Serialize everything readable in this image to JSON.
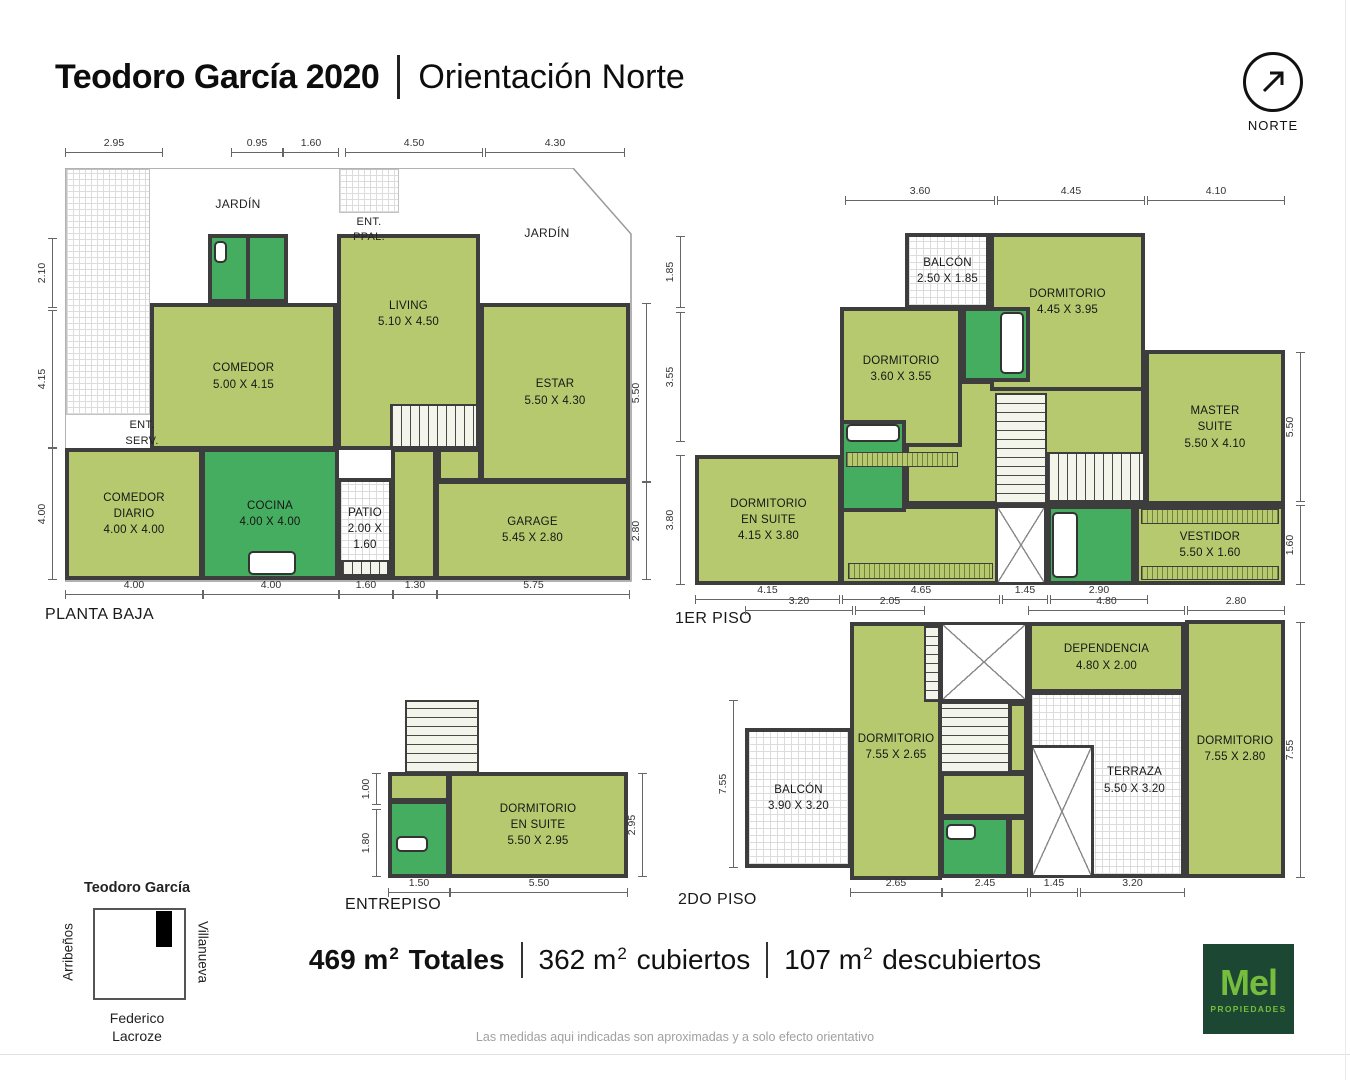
{
  "title": {
    "bold": "Teodoro García 2020",
    "separator": "|",
    "regular": "Orientación Norte"
  },
  "north": {
    "label": "NORTE"
  },
  "colors": {
    "room_light": "#b6c96e",
    "room_dark": "#45ad5f",
    "wall": "#3d3d3d",
    "logo_bg": "#1b4733",
    "logo_green": "#76bd3d"
  },
  "plans": [
    {
      "id": "planta-baja",
      "title": {
        "t": "PLANTA BAJA",
        "x": 45,
        "y": 606
      },
      "elements": [
        {
          "n": "jardin-hatch-left",
          "f": "lothatch",
          "x": 66,
          "y": 169,
          "w": 84,
          "h": 246
        },
        {
          "n": "ent-ppal-hatch",
          "f": "lothatch",
          "x": 339,
          "y": 169,
          "w": 60,
          "h": 44
        },
        {
          "n": "room-wet-a",
          "f": "dark",
          "x": 208,
          "y": 234,
          "w": 42,
          "h": 69
        },
        {
          "n": "room-wet-b",
          "f": "dark",
          "x": 246,
          "y": 234,
          "w": 42,
          "h": 69
        },
        {
          "n": "room-comedor",
          "f": "light",
          "x": 150,
          "y": 303,
          "w": 187,
          "h": 147,
          "lines": [
            "COMEDOR",
            "5.00 X 4.15"
          ]
        },
        {
          "n": "room-living",
          "f": "light",
          "x": 337,
          "y": 234,
          "w": 143,
          "h": 216,
          "lines": [
            "LIVING",
            "5.10 X 4.50"
          ],
          "ldy": -28
        },
        {
          "n": "room-estar",
          "f": "light",
          "x": 480,
          "y": 303,
          "w": 150,
          "h": 179,
          "lines": [
            "ESTAR",
            "5.50 X 4.30"
          ]
        },
        {
          "n": "room-comedor-diario",
          "f": "light",
          "x": 65,
          "y": 448,
          "w": 138,
          "h": 132,
          "lines": [
            "COMEDOR",
            "DIARIO",
            "4.00 X 4.00"
          ]
        },
        {
          "n": "room-cocina",
          "f": "dark",
          "x": 201,
          "y": 448,
          "w": 138,
          "h": 132,
          "lines": [
            "COCINA",
            "4.00 X 4.00"
          ]
        },
        {
          "n": "stairs-pb",
          "f": "stair-v",
          "x": 390,
          "y": 404,
          "w": 88,
          "h": 44
        },
        {
          "n": "hall-pb",
          "f": "light",
          "x": 391,
          "y": 448,
          "w": 46,
          "h": 132
        },
        {
          "n": "mid-strip-pb",
          "f": "light",
          "x": 437,
          "y": 448,
          "w": 45,
          "h": 34
        },
        {
          "n": "room-patio",
          "f": "hatch",
          "x": 337,
          "y": 478,
          "w": 56,
          "h": 102,
          "lines": [
            "PATIO",
            "2.00 X 1.60"
          ]
        },
        {
          "n": "room-garage",
          "f": "light",
          "x": 435,
          "y": 480,
          "w": 195,
          "h": 100,
          "lines": [
            "GARAGE",
            "5.45 X 2.80"
          ]
        },
        {
          "n": "patio-step-hatch",
          "f": "stair-v",
          "x": 341,
          "y": 560,
          "w": 48,
          "h": 16
        },
        {
          "n": "fixture-stove",
          "f": "fixture",
          "x": 248,
          "y": 551,
          "w": 48,
          "h": 24
        },
        {
          "n": "fixture-wet",
          "f": "fixture",
          "x": 214,
          "y": 241,
          "w": 13,
          "h": 22
        }
      ],
      "dims": [
        {
          "t": "2.95",
          "o": "h",
          "x": 65,
          "y": 152,
          "len": 98
        },
        {
          "t": "0.95",
          "o": "h",
          "x": 231,
          "y": 152,
          "len": 52
        },
        {
          "t": "1.60",
          "o": "h",
          "x": 283,
          "y": 152,
          "len": 56
        },
        {
          "t": "4.50",
          "o": "h",
          "x": 345,
          "y": 152,
          "len": 138
        },
        {
          "t": "4.30",
          "o": "h",
          "x": 485,
          "y": 152,
          "len": 140
        },
        {
          "t": "2.10",
          "o": "v",
          "x": 52,
          "y": 238,
          "len": 70
        },
        {
          "t": "4.15",
          "o": "v",
          "x": 52,
          "y": 310,
          "len": 138
        },
        {
          "t": "4.00",
          "o": "v",
          "x": 52,
          "y": 448,
          "len": 132
        },
        {
          "t": "5.50",
          "o": "v",
          "x": 646,
          "y": 303,
          "len": 179
        },
        {
          "t": "2.80",
          "o": "v",
          "x": 646,
          "y": 482,
          "len": 98
        },
        {
          "t": "4.00",
          "o": "h",
          "x": 65,
          "y": 594,
          "len": 138
        },
        {
          "t": "4.00",
          "o": "h",
          "x": 203,
          "y": 594,
          "len": 136
        },
        {
          "t": "1.60",
          "o": "h",
          "x": 339,
          "y": 594,
          "len": 54
        },
        {
          "t": "1.30",
          "o": "h",
          "x": 393,
          "y": 594,
          "len": 44
        },
        {
          "t": "5.75",
          "o": "h",
          "x": 437,
          "y": 594,
          "len": 193
        }
      ],
      "texts": [
        {
          "n": "jardin-label-left",
          "t": "JARDÍN",
          "x": 238,
          "y": 204,
          "size": 12
        },
        {
          "n": "jardin-label-right",
          "t": "JARDÍN",
          "x": 547,
          "y": 233,
          "size": 12
        },
        {
          "n": "ent-ppal-line1",
          "t": "ENT.",
          "x": 369,
          "y": 222,
          "size": 11
        },
        {
          "n": "ent-ppal-line2",
          "t": "PPAL.",
          "x": 369,
          "y": 237,
          "size": 11
        },
        {
          "n": "ent-serv-line1",
          "t": "ENT.",
          "x": 142,
          "y": 425,
          "size": 11
        },
        {
          "n": "ent-serv-line2",
          "t": "SERV.",
          "x": 142,
          "y": 441,
          "size": 11
        }
      ]
    },
    {
      "id": "1er-piso",
      "title": {
        "t": "1ER PISO",
        "x": 675,
        "y": 610
      },
      "elements": [
        {
          "n": "hall-1p",
          "f": "light",
          "x": 905,
          "y": 380,
          "w": 240,
          "h": 125
        },
        {
          "n": "closet-zone-1p",
          "f": "light",
          "x": 840,
          "y": 505,
          "w": 160,
          "h": 80
        },
        {
          "n": "room-balcon-1p",
          "f": "hatch",
          "x": 905,
          "y": 233,
          "w": 85,
          "h": 76,
          "lines": [
            "BALCÓN",
            "2.50 X 1.85"
          ]
        },
        {
          "n": "room-dormitorio-445",
          "f": "light",
          "x": 990,
          "y": 233,
          "w": 155,
          "h": 158,
          "lines": [
            "DORMITORIO",
            "4.45 X 3.95"
          ],
          "ldy": -10
        },
        {
          "n": "room-dormitorio-360",
          "f": "light",
          "x": 840,
          "y": 307,
          "w": 122,
          "h": 140,
          "lines": [
            "DORMITORIO",
            "3.60 X 3.55"
          ],
          "ldy": -8
        },
        {
          "n": "bath-1p-top",
          "f": "dark",
          "x": 962,
          "y": 307,
          "w": 68,
          "h": 75
        },
        {
          "n": "room-master-suite",
          "f": "light",
          "x": 1145,
          "y": 350,
          "w": 140,
          "h": 155,
          "lines": [
            "MASTER",
            "SUITE",
            "5.50 X 4.10"
          ]
        },
        {
          "n": "room-vestidor",
          "f": "light",
          "x": 1135,
          "y": 505,
          "w": 150,
          "h": 80,
          "lines": [
            "VESTIDOR",
            "5.50 X 1.60"
          ]
        },
        {
          "n": "closet-stripe-top",
          "f": "stripe-v",
          "x": 1141,
          "y": 509,
          "w": 138,
          "h": 15
        },
        {
          "n": "closet-stripe-bottom",
          "f": "stripe-v",
          "x": 1141,
          "y": 566,
          "w": 138,
          "h": 14
        },
        {
          "n": "room-dormitorio-en-suite-1p",
          "f": "light",
          "x": 695,
          "y": 455,
          "w": 147,
          "h": 130,
          "lines": [
            "DORMITORIO",
            "EN SUITE",
            "4.15 X 3.80"
          ]
        },
        {
          "n": "bath-1p-mid",
          "f": "dark",
          "x": 840,
          "y": 420,
          "w": 66,
          "h": 92
        },
        {
          "n": "stairs-1p-a",
          "f": "stair-h",
          "x": 995,
          "y": 393,
          "w": 52,
          "h": 112
        },
        {
          "n": "stairs-1p-b",
          "f": "stair-v",
          "x": 1047,
          "y": 452,
          "w": 98,
          "h": 50
        },
        {
          "n": "shaft-1p",
          "f": "shaft",
          "x": 995,
          "y": 505,
          "w": 52,
          "h": 80
        },
        {
          "n": "bath-1p-bottom",
          "f": "dark",
          "x": 1047,
          "y": 505,
          "w": 88,
          "h": 80
        },
        {
          "n": "stripe-1p-left",
          "f": "stripe-v",
          "x": 846,
          "y": 452,
          "w": 112,
          "h": 15
        },
        {
          "n": "stripe-1p-bottomleft",
          "f": "stripe-v",
          "x": 848,
          "y": 563,
          "w": 145,
          "h": 16
        },
        {
          "n": "fixture-tub-mid",
          "f": "fixture",
          "x": 846,
          "y": 424,
          "w": 54,
          "h": 18
        },
        {
          "n": "fixture-tub-top",
          "f": "fixture",
          "x": 1000,
          "y": 312,
          "w": 24,
          "h": 62
        },
        {
          "n": "fixture-tub-bottom",
          "f": "fixture",
          "x": 1052,
          "y": 512,
          "w": 26,
          "h": 66
        }
      ],
      "dims": [
        {
          "t": "3.60",
          "o": "h",
          "x": 845,
          "y": 200,
          "len": 150
        },
        {
          "t": "4.45",
          "o": "h",
          "x": 997,
          "y": 200,
          "len": 148
        },
        {
          "t": "4.10",
          "o": "h",
          "x": 1147,
          "y": 200,
          "len": 138
        },
        {
          "t": "1.85",
          "o": "v",
          "x": 680,
          "y": 236,
          "len": 72
        },
        {
          "t": "3.55",
          "o": "v",
          "x": 680,
          "y": 312,
          "len": 130
        },
        {
          "t": "3.80",
          "o": "v",
          "x": 680,
          "y": 455,
          "len": 130
        },
        {
          "t": "5.50",
          "o": "v",
          "x": 1300,
          "y": 352,
          "len": 150
        },
        {
          "t": "1.60",
          "o": "v",
          "x": 1300,
          "y": 505,
          "len": 80
        },
        {
          "t": "4.15",
          "o": "h",
          "x": 695,
          "y": 599,
          "len": 145
        },
        {
          "t": "4.65",
          "o": "h",
          "x": 842,
          "y": 599,
          "len": 158
        },
        {
          "t": "1.45",
          "o": "h",
          "x": 1002,
          "y": 599,
          "len": 46
        },
        {
          "t": "2.90",
          "o": "h",
          "x": 1050,
          "y": 599,
          "len": 98
        }
      ],
      "texts": []
    },
    {
      "id": "entrepiso",
      "title": {
        "t": "ENTREPISO",
        "x": 345,
        "y": 896
      },
      "elements": [
        {
          "n": "stairs-ep",
          "f": "stair-h",
          "x": 405,
          "y": 700,
          "w": 74,
          "h": 74
        },
        {
          "n": "hall-ep",
          "f": "light",
          "x": 388,
          "y": 772,
          "w": 62,
          "h": 30
        },
        {
          "n": "bath-ep",
          "f": "dark",
          "x": 388,
          "y": 800,
          "w": 62,
          "h": 78
        },
        {
          "n": "room-dormitorio-en-suite-ep",
          "f": "light",
          "x": 448,
          "y": 772,
          "w": 180,
          "h": 106,
          "lines": [
            "DORMITORIO",
            "EN SUITE",
            "5.50 X 2.95"
          ]
        },
        {
          "n": "fixture-ep",
          "f": "fixture",
          "x": 396,
          "y": 836,
          "w": 32,
          "h": 16
        }
      ],
      "dims": [
        {
          "t": "1.00",
          "o": "v",
          "x": 376,
          "y": 773,
          "len": 32
        },
        {
          "t": "1.80",
          "o": "v",
          "x": 376,
          "y": 809,
          "len": 68
        },
        {
          "t": "2.95",
          "o": "v",
          "x": 642,
          "y": 773,
          "len": 104
        },
        {
          "t": "1.50",
          "o": "h",
          "x": 388,
          "y": 892,
          "len": 62
        },
        {
          "t": "5.50",
          "o": "h",
          "x": 450,
          "y": 892,
          "len": 178
        }
      ],
      "texts": []
    },
    {
      "id": "2do-piso",
      "title": {
        "t": "2DO PISO",
        "x": 678,
        "y": 891
      },
      "elements": [
        {
          "n": "room-dormitorio-755-265",
          "f": "light",
          "x": 850,
          "y": 622,
          "w": 92,
          "h": 258,
          "lines": [
            "DORMITORIO",
            "7.55 X 2.65"
          ],
          "ldy": -4
        },
        {
          "n": "stair-strip-2p",
          "f": "stair-h",
          "x": 924,
          "y": 626,
          "w": 16,
          "h": 76
        },
        {
          "n": "xarea-2p",
          "f": "shaft",
          "x": 940,
          "y": 622,
          "w": 88,
          "h": 80
        },
        {
          "n": "stairs-2p",
          "f": "stair-h",
          "x": 940,
          "y": 702,
          "w": 70,
          "h": 72
        },
        {
          "n": "filler-2p",
          "f": "light",
          "x": 1008,
          "y": 702,
          "w": 20,
          "h": 72
        },
        {
          "n": "hall-2p",
          "f": "light",
          "x": 940,
          "y": 772,
          "w": 88,
          "h": 46
        },
        {
          "n": "bath-2p",
          "f": "dark",
          "x": 940,
          "y": 816,
          "w": 70,
          "h": 62
        },
        {
          "n": "filler2-2p",
          "f": "light",
          "x": 1008,
          "y": 816,
          "w": 20,
          "h": 62
        },
        {
          "n": "room-dependencia",
          "f": "light",
          "x": 1028,
          "y": 622,
          "w": 157,
          "h": 71,
          "lines": [
            "DEPENDENCIA",
            "4.80 X 2.00"
          ]
        },
        {
          "n": "room-terraza",
          "f": "hatch",
          "x": 1028,
          "y": 691,
          "w": 157,
          "h": 187,
          "lines": [
            "TERRAZA",
            "5.50 X 3.20"
          ],
          "ldx": 28,
          "ldy": -4
        },
        {
          "n": "shaft-2p",
          "f": "shaft",
          "x": 1030,
          "y": 745,
          "w": 64,
          "h": 133
        },
        {
          "n": "room-dormitorio-755-280",
          "f": "light",
          "x": 1185,
          "y": 620,
          "w": 100,
          "h": 258,
          "lines": [
            "DORMITORIO",
            "7.55 X 2.80"
          ]
        },
        {
          "n": "room-balcon-2p",
          "f": "hatch",
          "x": 745,
          "y": 728,
          "w": 107,
          "h": 140,
          "lines": [
            "BALCÓN",
            "3.90 X 3.20"
          ]
        },
        {
          "n": "fixture-2p",
          "f": "fixture",
          "x": 946,
          "y": 824,
          "w": 30,
          "h": 16
        }
      ],
      "dims": [
        {
          "t": "3.20",
          "o": "h",
          "x": 745,
          "y": 610,
          "len": 108
        },
        {
          "t": "2.05",
          "o": "h",
          "x": 855,
          "y": 610,
          "len": 70
        },
        {
          "t": "4.80",
          "o": "h",
          "x": 1028,
          "y": 610,
          "len": 157
        },
        {
          "t": "2.80",
          "o": "h",
          "x": 1187,
          "y": 610,
          "len": 98
        },
        {
          "t": "7.55",
          "o": "v",
          "x": 733,
          "y": 700,
          "len": 168
        },
        {
          "t": "7.55",
          "o": "v",
          "x": 1300,
          "y": 622,
          "len": 256
        },
        {
          "t": "2.65",
          "o": "h",
          "x": 850,
          "y": 892,
          "len": 92
        },
        {
          "t": "2.45",
          "o": "h",
          "x": 942,
          "y": 892,
          "len": 86
        },
        {
          "t": "1.45",
          "o": "h",
          "x": 1030,
          "y": 892,
          "len": 48
        },
        {
          "t": "3.20",
          "o": "h",
          "x": 1080,
          "y": 892,
          "len": 105
        }
      ],
      "texts": []
    }
  ],
  "totals": {
    "unit": "m",
    "superscript": "2",
    "items": [
      {
        "number": "469",
        "word": "Totales",
        "bold": true
      },
      {
        "number": "362",
        "word": "cubiertos",
        "bold": false
      },
      {
        "number": "107",
        "word": "descubiertos",
        "bold": false
      }
    ]
  },
  "map": {
    "street_top": "Teodoro García",
    "street_left": "Arribeños",
    "street_right": "Villanueva",
    "street_bottom_line1": "Federico",
    "street_bottom_line2": "Lacroze"
  },
  "logo": {
    "name": "Mel",
    "subtitle": "PROPIEDADES"
  },
  "disclaimer": "Las medidas aqui indicadas son aproximadas y a solo efecto orientativo"
}
